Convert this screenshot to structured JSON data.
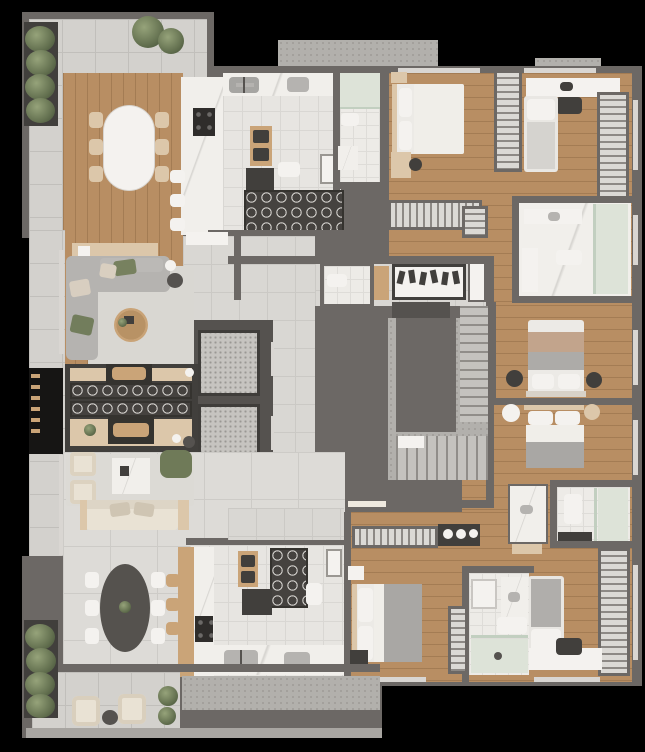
{
  "document": {
    "kind": "architectural floor plan",
    "rendering": "photorealistic top-down 3D render",
    "background": "black",
    "visible_text": "none",
    "layout": "two private residences around a shared central core"
  },
  "palette": {
    "wall": "#6c6865",
    "wood_floor": "#b88e63",
    "kitchen_tile": "#e7e5e1",
    "living_tile": "#dddbd7",
    "balcony_tile": "#d3d1cd",
    "hall_tile": "#d9d7d3",
    "bath_tile": "#edebe7",
    "marble": "#f1efeb",
    "concrete_slab": "#b2b0ac",
    "elevator_terrazzo": "#c6c4c0",
    "dark_joinery": "#413f3c",
    "sofa_gray": "#b5b3b0",
    "cream_upholstery": "#e9e2d4",
    "accent_green": "#6f7a58",
    "bedding_white": "#f0eee9",
    "blanket_gray": "#a9a7a4",
    "blanket_tan": "#c2a48c",
    "wood_furniture": "#caa478",
    "shower_glass_green": "#dde3d8"
  },
  "core": {
    "elevators": 2,
    "stair": "U-shaped switchback stair",
    "entry_items": [
      "shoe rack with 6 pairs of shoes",
      "wood cabinet",
      "tall storage cabinet",
      "door mat"
    ],
    "guest_wc": [
      "toilet"
    ]
  },
  "upper_unit": {
    "terrace": [
      "hedge planter wall",
      "2 ornamental bushes",
      "pale tile paving"
    ],
    "dining": [
      "oval white marble table",
      "6 dining chairs"
    ],
    "kitchen": [
      "marble island with 4-burner cooktop",
      "3 white bar stools",
      "double sink",
      "single sink",
      "oven column",
      "dark pantry cabinet",
      "wine storage rack with round cells",
      "utility cabinet",
      "service toilet"
    ],
    "service_bathroom": [
      "shower",
      "toilet",
      "vanity"
    ],
    "living": [
      "L-shaped gray sofa",
      "green and beige throw pillows",
      "round wood coffee table",
      "area rug",
      "wood console",
      "sphere lamp",
      "round side table"
    ],
    "fireplace_wall": [
      "double-sided unit",
      "2 firewood niches",
      "2 rows of round wine racks",
      "display benches",
      "small plant"
    ],
    "bedroom_1": [
      "double bed",
      "nightstand",
      "desk with chair",
      "wardrobe"
    ],
    "bedroom_2": [
      "single bed",
      "built-in desk",
      "laptop",
      "desk chair",
      "wardrobe"
    ],
    "master_bathroom": [
      "two vanities",
      "toilet",
      "green glass shower"
    ],
    "master_suite": [
      "walk-in wardrobe",
      "double bed",
      "2 round dark nightstands"
    ]
  },
  "lower_unit": {
    "living": [
      "cream three-seat sofa",
      "2 cream armchairs",
      "green armchair",
      "square marble coffee table",
      "area rug",
      "sphere lamp",
      "round side table"
    ],
    "dining": [
      "dark oval table",
      "6 light chairs",
      "green plant centerpiece"
    ],
    "kitchen": [
      "wood and marble island with cooktop",
      "3 wood bar stools",
      "double sink",
      "single sink",
      "oven column",
      "wine storage rack",
      "utility cabinet",
      "service toilet"
    ],
    "suite_bedroom": [
      "double bed",
      "2 round nightstands"
    ],
    "bedroom_3": [
      "double bed with gray duvet",
      "closet run",
      "cabinet with round pots",
      "nightstand"
    ],
    "bedroom_4": [
      "single bed",
      "built-in desk",
      "desk chair",
      "2 wardrobes"
    ],
    "bathroom_a": [
      "freestanding marble vanity",
      "bench",
      "toilet",
      "green glass shower"
    ],
    "bathroom_b": [
      "counter",
      "marble vanity",
      "toilet",
      "green glass shower"
    ],
    "balcony": [
      "2 wicker armchairs",
      "round dark ottoman",
      "2 bushes",
      "hedge planter wall"
    ],
    "service_balcony": [
      "concrete deck"
    ]
  }
}
